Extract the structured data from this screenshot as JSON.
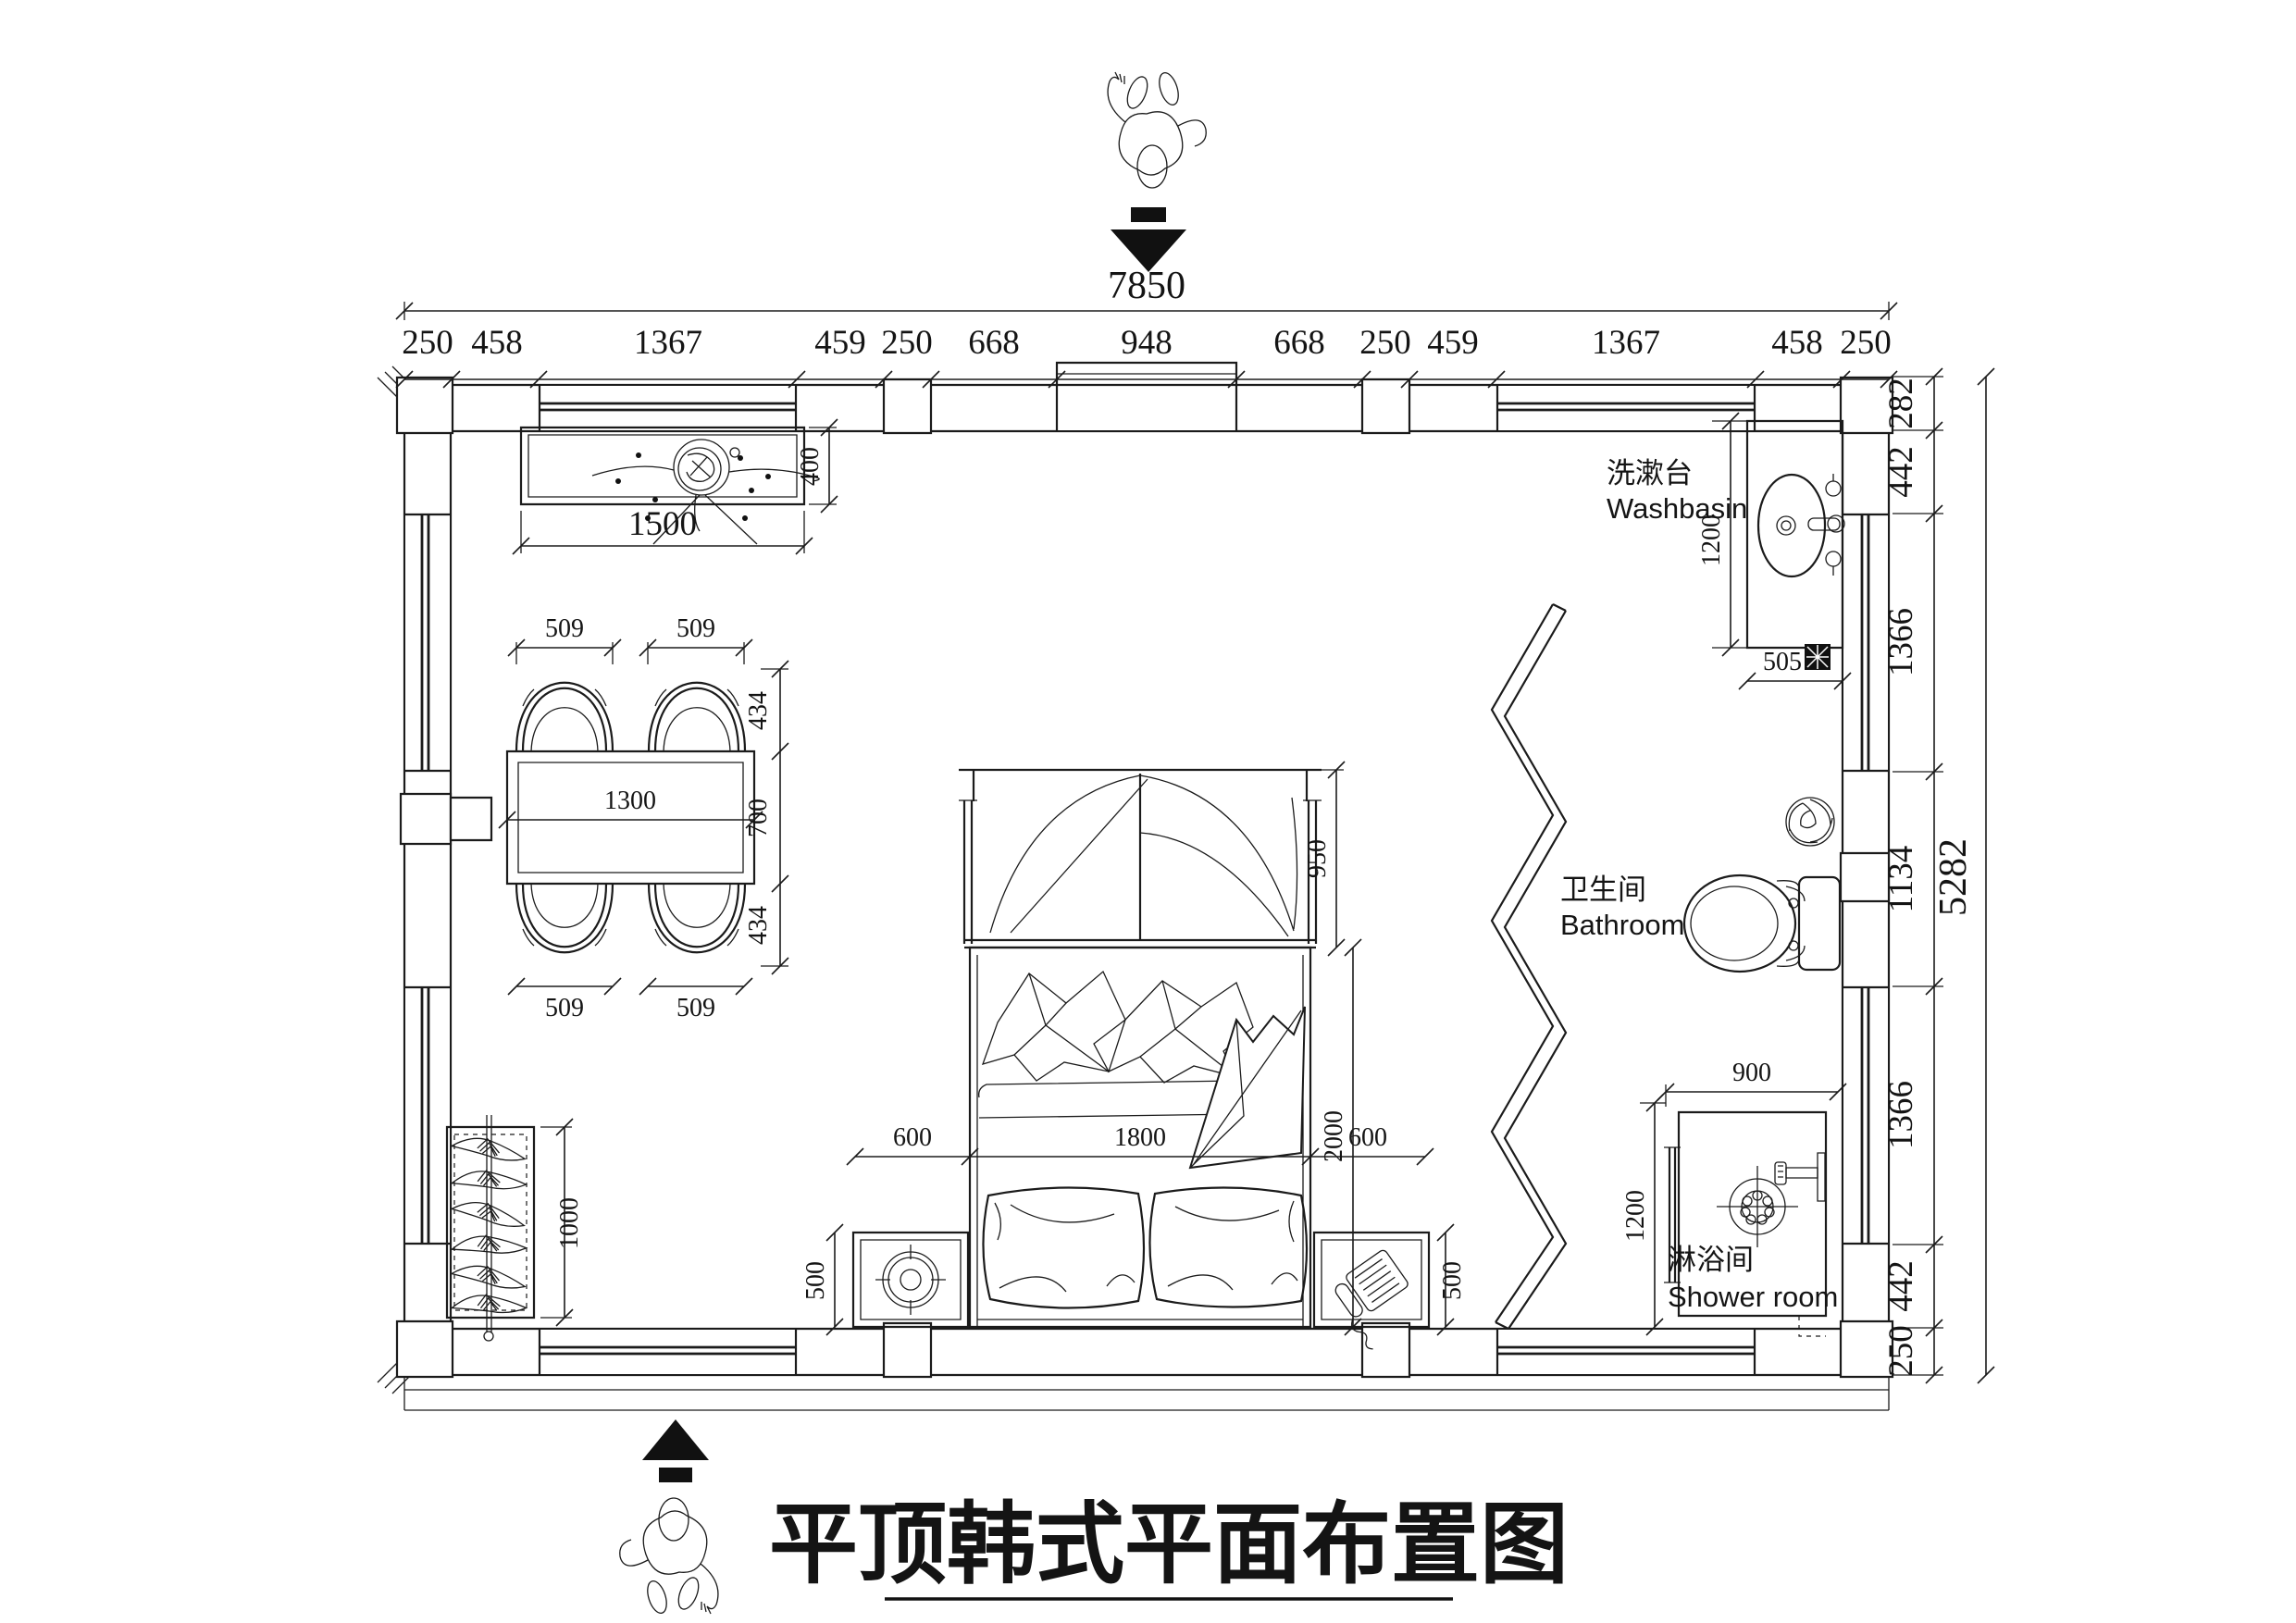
{
  "title": {
    "text": "平顶韩式平面布置图"
  },
  "overall": {
    "width": "7850",
    "height": "5282"
  },
  "top_chain": [
    "250",
    "458",
    "1367",
    "459",
    "250",
    "668",
    "948",
    "668",
    "250",
    "459",
    "1367",
    "458",
    "250"
  ],
  "right_chain": [
    "282",
    "442",
    "1366",
    "1134",
    "1366",
    "442",
    "250"
  ],
  "rooms": {
    "washbasin_zh": "洗漱台",
    "washbasin_en": "Washbasin",
    "bathroom_zh": "卫生间",
    "bathroom_en": "Bathroom",
    "shower_zh": "淋浴间",
    "shower_en": "Shower room"
  },
  "dims": {
    "console_width": "1500",
    "console_depth": "400",
    "table_width": "1300",
    "table_depth": "700",
    "chair_width": "509",
    "chair_depth": "434",
    "wardrobe_height": "1000",
    "bed_width": "1800",
    "bed_length": "2000",
    "bed_canopy": "950",
    "bed_side": "600",
    "nightstand": "500",
    "washbasin_depth": "1200",
    "washbasin_width": "505",
    "shower_width": "900",
    "shower_depth": "1200"
  }
}
